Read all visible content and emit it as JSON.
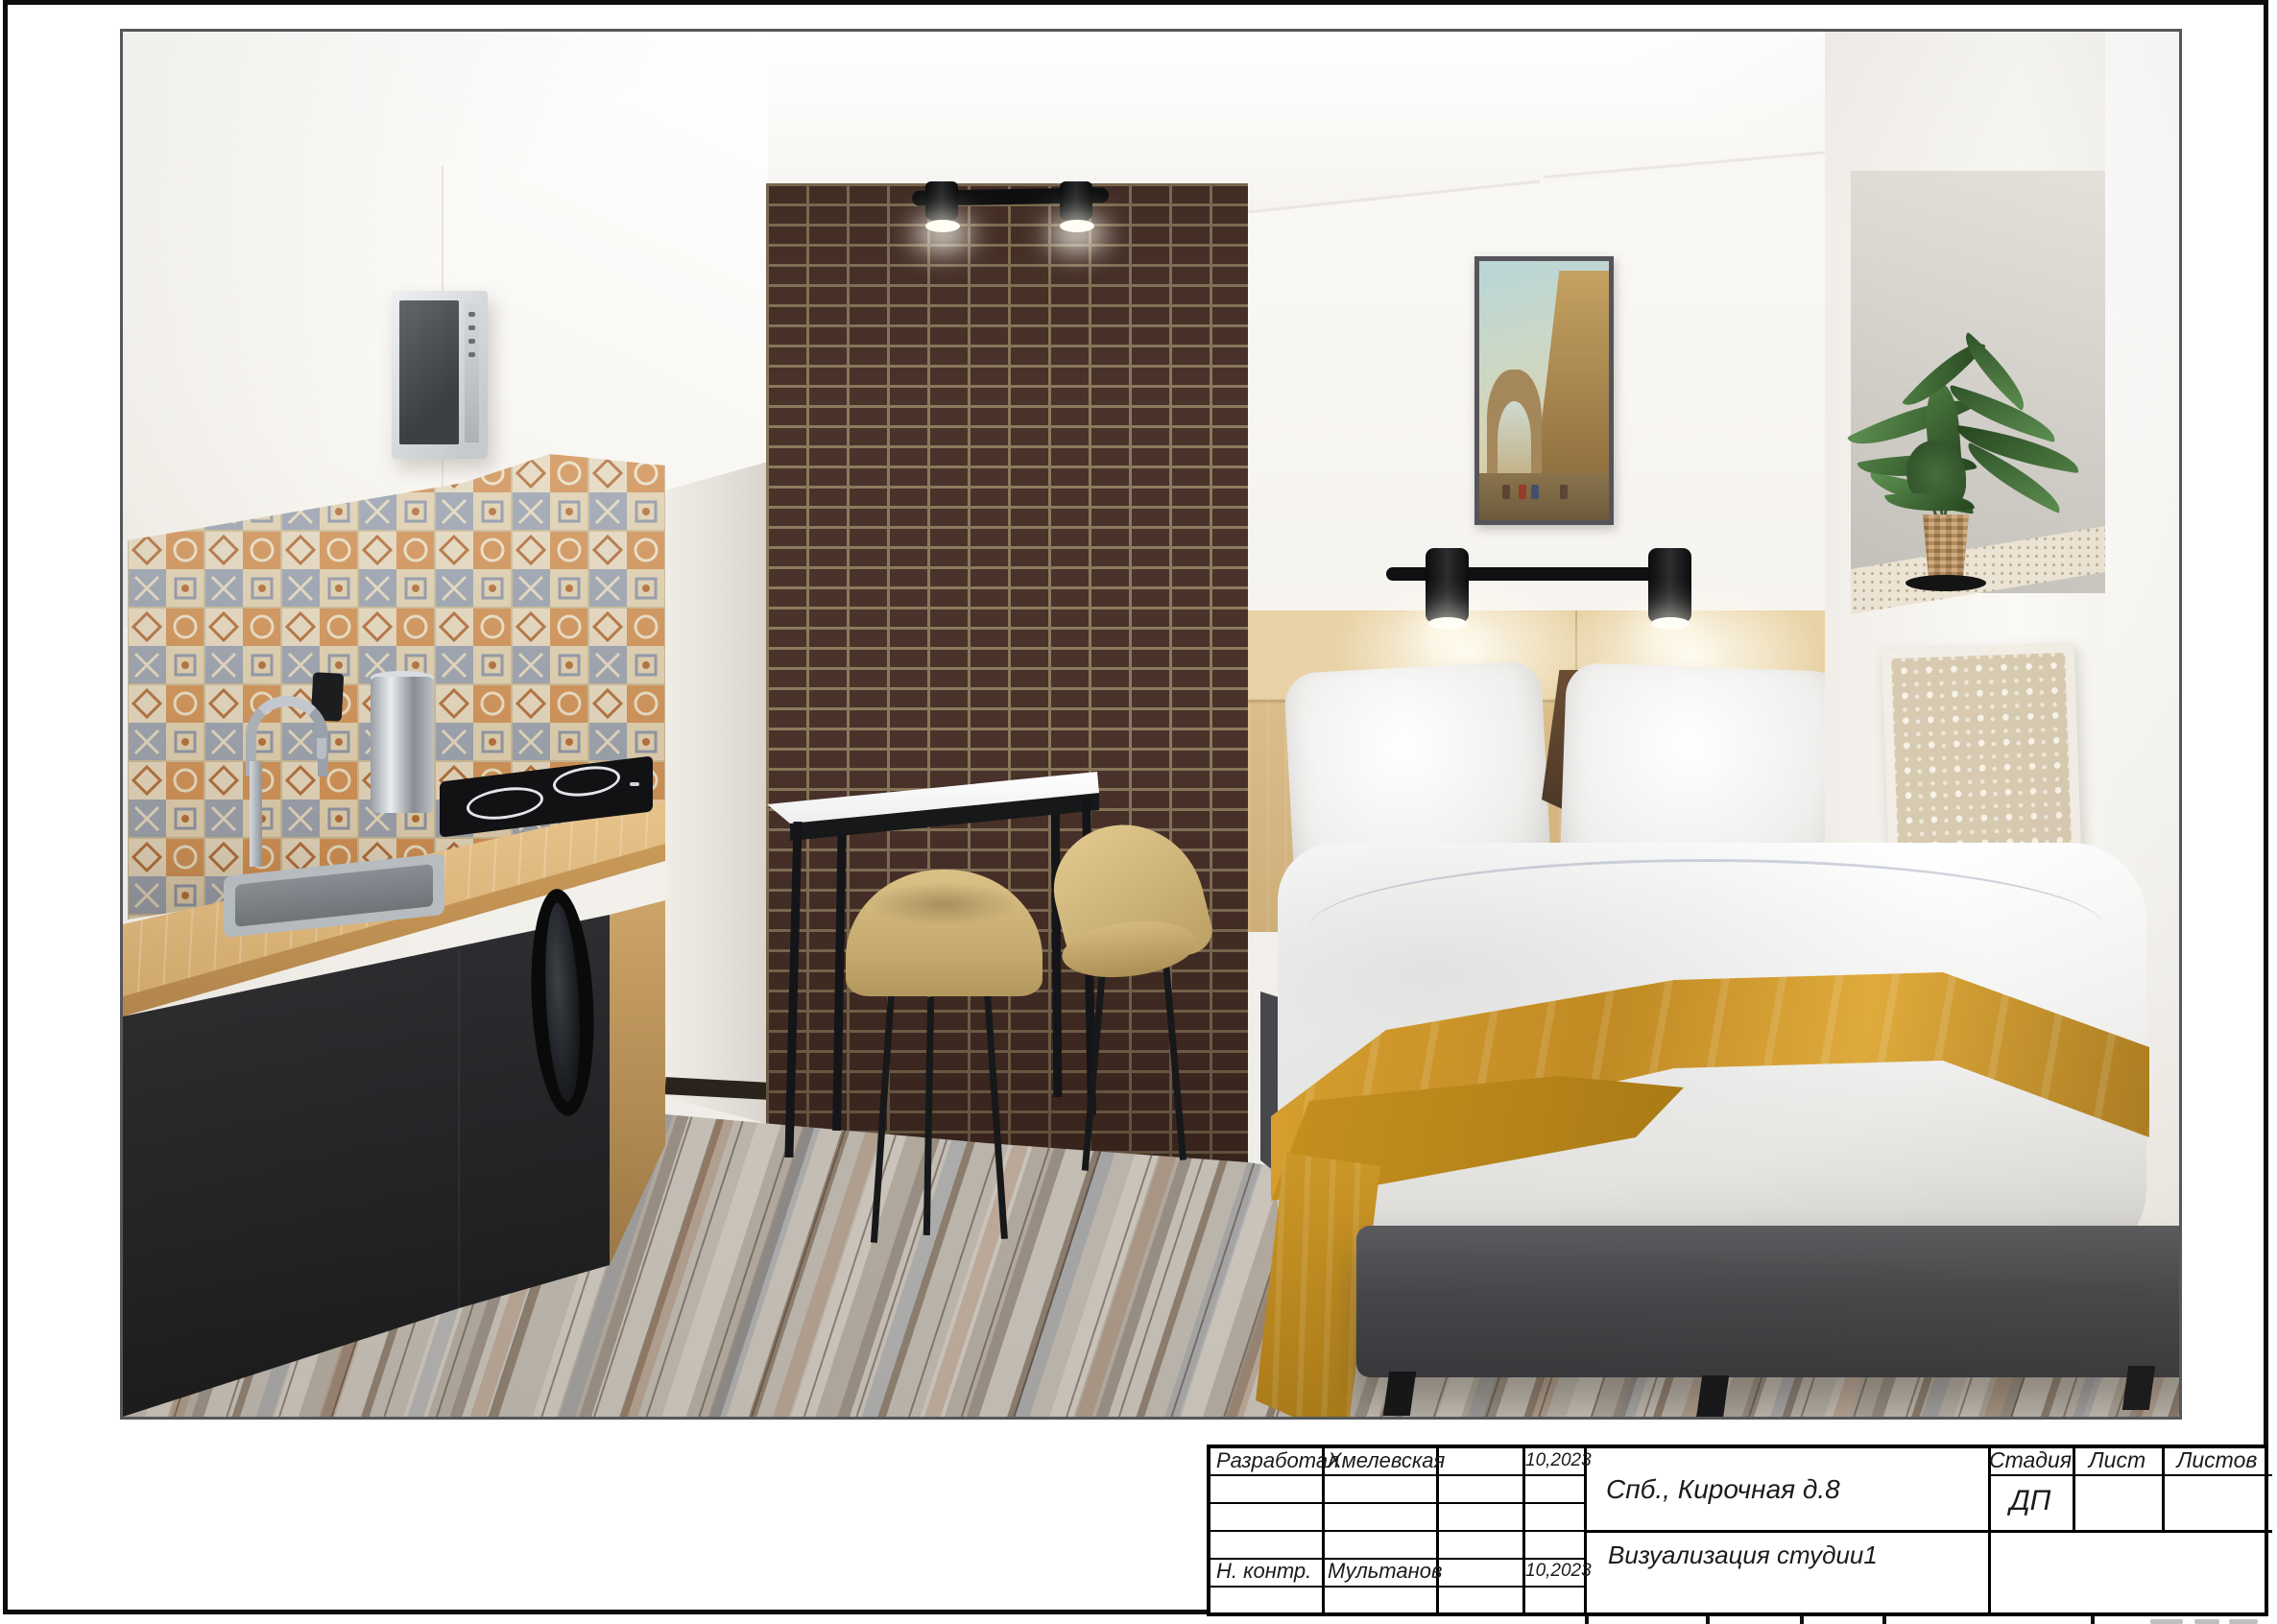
{
  "title_block": {
    "developed_label": "Разработал",
    "developed_name": "Хмелевская",
    "developed_date": "10,2023",
    "normcontrol_label": "Н. контр.",
    "normcontrol_name": "Мультанов",
    "normcontrol_date": "10,2023",
    "object_address": "Спб., Кирочная д.8",
    "sheet_title": "Визуализация студии1",
    "stage_header": "Стадия",
    "sheet_header": "Лист",
    "sheets_header": "Листов",
    "stage_value": "ДП"
  },
  "palette": {
    "brick_wall": "#4a332b",
    "brick_mortar": "#8b7a5d",
    "counter_wood": "#d2a869",
    "headboard_wood": "#d9bd8d",
    "throw_blanket": "#d49a2e",
    "bed_base": "#454649",
    "cabinet_dark": "#1d1e20",
    "chair_beige": "#cdb277",
    "tile_orange": "#cf8f52",
    "tile_blue_gray": "#97a0ae",
    "tile_cream": "#e3d7bd",
    "plant_green": "#4e7d43",
    "floor_gray": "#b0a89d"
  }
}
